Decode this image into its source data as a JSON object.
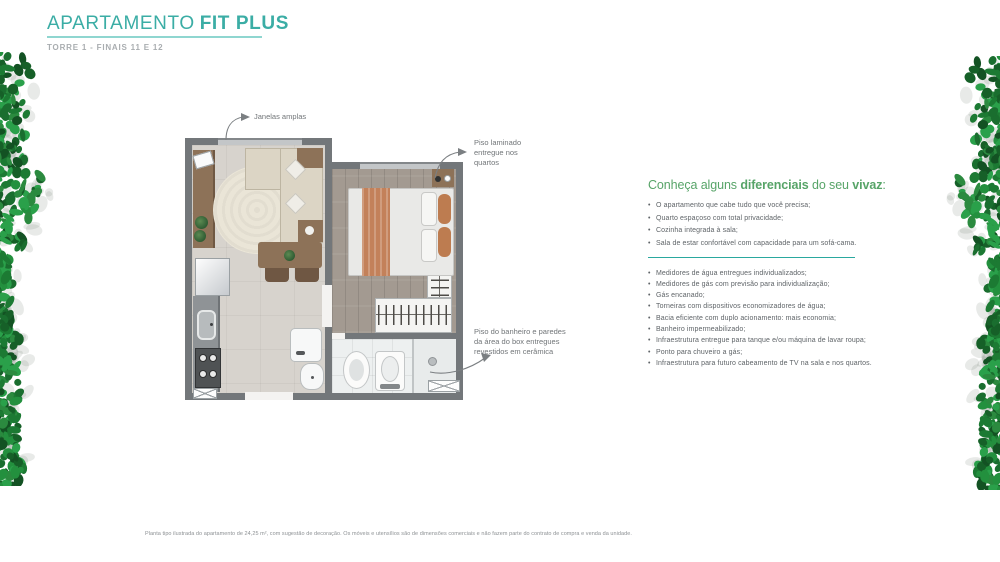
{
  "header": {
    "title_regular": "APARTAMENTO",
    "title_bold": "FIT PLUS",
    "subtitle": "TORRE 1 - FINAIS 11 E 12"
  },
  "floorplan": {
    "callout_windows": "Janelas amplas",
    "callout_laminate": "Piso laminado\nentregue nos\nquartos",
    "callout_ceramic": "Piso do banheiro e paredes\nda área do box entregues\nrevestidos em cerâmica"
  },
  "features": {
    "heading_part1": "Conheça alguns ",
    "heading_bold1": "diferenciais",
    "heading_part2": " do seu ",
    "heading_bold2": "vivaz",
    "heading_part3": ":",
    "list1": [
      "O apartamento que cabe tudo que você precisa;",
      "Quarto espaçoso com total privacidade;",
      "Cozinha integrada à sala;",
      "Sala de estar confortável com capacidade para um sofá-cama."
    ],
    "list2": [
      "Medidores de água entregues individualizados;",
      "Medidores de gás com previsão para individualização;",
      "Gás encanado;",
      "Torneiras com dispositivos economizadores de água;",
      "Bacia eficiente com duplo acionamento: mais economia;",
      "Banheiro impermeabilizado;",
      "Infraestrutura entregue para tanque e/ou máquina de lavar roupa;",
      "Ponto para chuveiro a gás;",
      "Infraestrutura para futuro cabeamento de TV na sala e nos quartos."
    ]
  },
  "footer": {
    "disclaimer": "Planta tipo ilustrada do apartamento de 24,25 m², com sugestão de decoração. Os móveis e utensílios são de dimensões comerciais e não fazem parte do contrato de compra e venda da unidade."
  },
  "colors": {
    "title_teal": "#3bada5",
    "underline_teal": "#8fd6d0",
    "heading_green": "#57a468",
    "divider_teal": "#2aa89f",
    "body_text_gray": "#5f6468",
    "subtitle_gray": "#a9adb0",
    "wall_gray": "#73777a",
    "bed_runner_orange": "#c3815a",
    "foliage_green": "#23903e"
  }
}
